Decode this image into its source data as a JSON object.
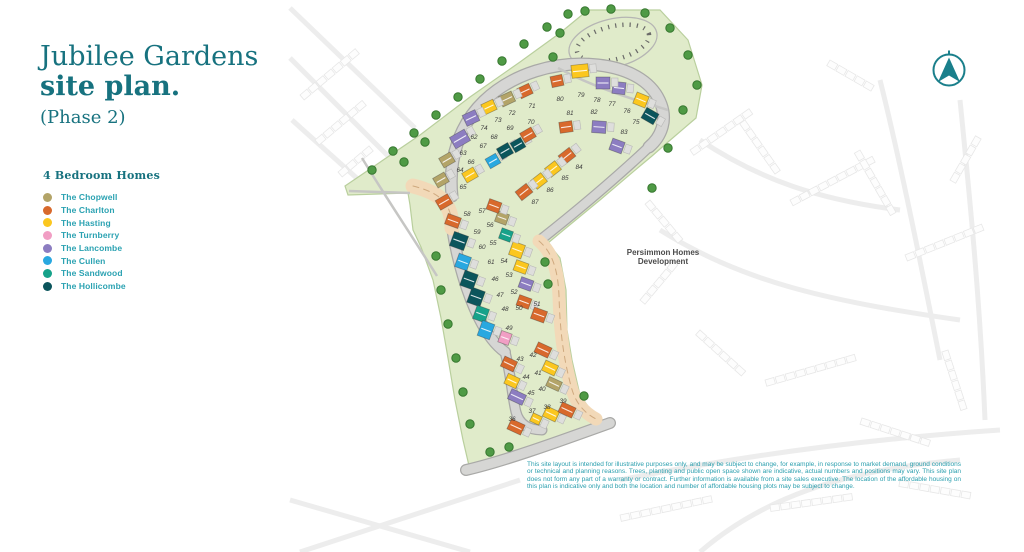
{
  "title": {
    "line1": "Jubilee Gardens",
    "line2": "site plan.",
    "phase": "(Phase 2)"
  },
  "legend": {
    "heading": "4 Bedroom Homes",
    "items": [
      {
        "key": "chopwell",
        "label": "The Chopwell",
        "color": "#b3a468"
      },
      {
        "key": "charlton",
        "label": "The Charlton",
        "color": "#d8692c"
      },
      {
        "key": "hasting",
        "label": "The Hasting",
        "color": "#fbc71f"
      },
      {
        "key": "turnberry",
        "label": "The Turnberry",
        "color": "#f19ec4"
      },
      {
        "key": "lancombe",
        "label": "The Lancombe",
        "color": "#8c7dc1"
      },
      {
        "key": "cullen",
        "label": "The Cullen",
        "color": "#29a8e0"
      },
      {
        "key": "sandwood",
        "label": "The Sandwood",
        "color": "#16a28a"
      },
      {
        "key": "hollicombe",
        "label": "The Hollicombe",
        "color": "#0b555c"
      }
    ]
  },
  "map": {
    "development_label_lines": [
      "Persimmon Homes",
      "Development"
    ],
    "site_colors": {
      "green": "#e0ebca",
      "green_edge": "#b9cf9d",
      "road": "#d6d6d4",
      "road_edge": "#a9a9a7",
      "tan_road": "#f2d9b8",
      "tan_dash": "#cfa97f",
      "tree": "#4f9a45",
      "tree_edge": "#36772f",
      "path": "#c6c6c4",
      "faint": "#e7e7e7"
    },
    "plots_columns": [
      "number",
      "type",
      "label_x",
      "label_y",
      "house_x",
      "house_y",
      "rotation",
      "width",
      "height"
    ],
    "plots": [
      [
        36,
        "charlton",
        512,
        419,
        516,
        427,
        25,
        15,
        11
      ],
      [
        37,
        "hasting",
        532,
        411,
        536,
        419,
        25,
        10,
        9
      ],
      [
        38,
        "hasting",
        547,
        407,
        551,
        414,
        25,
        14,
        11
      ],
      [
        39,
        "charlton",
        563,
        401,
        567,
        410,
        25,
        15,
        11
      ],
      [
        40,
        "chopwell",
        542,
        389,
        554,
        384,
        25,
        14,
        10
      ],
      [
        41,
        "hasting",
        538,
        373,
        550,
        368,
        25,
        14,
        11
      ],
      [
        42,
        "charlton",
        533,
        355,
        543,
        350,
        25,
        15,
        11
      ],
      [
        43,
        "charlton",
        520,
        359,
        509,
        364,
        25,
        14,
        11
      ],
      [
        44,
        "hasting",
        526,
        377,
        512,
        381,
        25,
        13,
        11
      ],
      [
        45,
        "lancombe",
        531,
        393,
        517,
        397,
        25,
        16,
        11
      ],
      [
        46,
        "hollicombe",
        495,
        279,
        476,
        297,
        20,
        14,
        16
      ],
      [
        47,
        "sandwood",
        500,
        295,
        481,
        314,
        20,
        13,
        14
      ],
      [
        48,
        "cullen",
        505,
        309,
        486,
        330,
        20,
        13,
        16
      ],
      [
        49,
        "turnberry",
        509,
        328,
        505,
        338,
        20,
        11,
        12
      ],
      [
        50,
        "charlton",
        519,
        308,
        524,
        302,
        20,
        13,
        11
      ],
      [
        51,
        "charlton",
        537,
        304,
        539,
        315,
        20,
        14,
        12
      ],
      [
        52,
        "lancombe",
        514,
        292,
        526,
        284,
        20,
        13,
        11
      ],
      [
        53,
        "hasting",
        509,
        275,
        521,
        267,
        20,
        13,
        11
      ],
      [
        54,
        "hasting",
        504,
        261,
        517,
        250,
        20,
        13,
        14
      ],
      [
        55,
        "sandwood",
        493,
        243,
        506,
        235,
        20,
        12,
        11
      ],
      [
        56,
        "chopwell",
        490,
        225,
        502,
        218,
        20,
        12,
        11
      ],
      [
        57,
        "charlton",
        482,
        211,
        494,
        206,
        20,
        13,
        11
      ],
      [
        58,
        "charlton",
        467,
        214,
        453,
        221,
        20,
        14,
        11
      ],
      [
        59,
        "hollicombe",
        477,
        232,
        459,
        241,
        20,
        15,
        15
      ],
      [
        60,
        "cullen",
        482,
        247,
        463,
        262,
        20,
        13,
        14
      ],
      [
        61,
        "hollicombe",
        491,
        262,
        469,
        280,
        20,
        14,
        16
      ],
      [
        62,
        "lancombe",
        474,
        137,
        460,
        139,
        -30,
        17,
        13
      ],
      [
        63,
        "chopwell",
        463,
        153,
        447,
        160,
        -30,
        13,
        11
      ],
      [
        64,
        "chopwell",
        460,
        170,
        441,
        180,
        -30,
        13,
        11
      ],
      [
        65,
        "charlton",
        463,
        187,
        444,
        202,
        -30,
        14,
        11
      ],
      [
        66,
        "hasting",
        471,
        162,
        470,
        175,
        -30,
        13,
        11
      ],
      [
        67,
        "cullen",
        483,
        146,
        493,
        161,
        -30,
        12,
        11
      ],
      [
        68,
        "hollicombe",
        494,
        137,
        505,
        151,
        -30,
        13,
        12
      ],
      [
        69,
        "hollicombe",
        510,
        128,
        518,
        145,
        -30,
        12,
        11
      ],
      [
        70,
        "charlton",
        531,
        122,
        528,
        135,
        -30,
        13,
        11
      ],
      [
        71,
        "charlton",
        532,
        106,
        525,
        91,
        -25,
        13,
        11
      ],
      [
        72,
        "chopwell",
        512,
        113,
        507,
        99,
        -25,
        14,
        11
      ],
      [
        73,
        "hasting",
        498,
        120,
        489,
        107,
        -25,
        13,
        11
      ],
      [
        74,
        "lancombe",
        484,
        128,
        471,
        118,
        -25,
        14,
        12
      ],
      [
        75,
        "hollicombe",
        636,
        122,
        650,
        116,
        30,
        14,
        12
      ],
      [
        76,
        "hasting",
        627,
        111,
        641,
        100,
        22,
        13,
        12
      ],
      [
        77,
        "lancombe",
        612,
        104,
        619,
        88,
        6,
        13,
        12
      ],
      [
        78,
        "lancombe",
        597,
        100,
        603,
        83,
        0,
        14,
        12
      ],
      [
        79,
        "hasting",
        581,
        95,
        580,
        71,
        -6,
        17,
        13
      ],
      [
        80,
        "charlton",
        560,
        99,
        557,
        81,
        -12,
        12,
        11
      ],
      [
        81,
        "charlton",
        570,
        113,
        566,
        127,
        -8,
        13,
        11
      ],
      [
        82,
        "lancombe",
        594,
        112,
        599,
        127,
        4,
        14,
        12
      ],
      [
        83,
        "lancombe",
        624,
        132,
        617,
        146,
        20,
        13,
        12
      ],
      [
        84,
        "charlton",
        579,
        167,
        567,
        156,
        -38,
        14,
        11
      ],
      [
        85,
        "hasting",
        565,
        178,
        553,
        169,
        -38,
        13,
        11
      ],
      [
        86,
        "hasting",
        550,
        190,
        539,
        181,
        -38,
        13,
        11
      ],
      [
        87,
        "charlton",
        535,
        202,
        524,
        192,
        -38,
        14,
        11
      ]
    ],
    "trees": [
      [
        372,
        170
      ],
      [
        393,
        151
      ],
      [
        414,
        133
      ],
      [
        436,
        115
      ],
      [
        458,
        97
      ],
      [
        480,
        79
      ],
      [
        502,
        61
      ],
      [
        524,
        44
      ],
      [
        547,
        27
      ],
      [
        568,
        14
      ],
      [
        404,
        162
      ],
      [
        425,
        142
      ],
      [
        585,
        11
      ],
      [
        611,
        9
      ],
      [
        645,
        13
      ],
      [
        670,
        28
      ],
      [
        688,
        55
      ],
      [
        697,
        85
      ],
      [
        683,
        110
      ],
      [
        560,
        33
      ],
      [
        553,
        57
      ],
      [
        652,
        188
      ],
      [
        668,
        148
      ],
      [
        436,
        256
      ],
      [
        441,
        290
      ],
      [
        448,
        324
      ],
      [
        456,
        358
      ],
      [
        463,
        392
      ],
      [
        470,
        424
      ],
      [
        490,
        452
      ],
      [
        509,
        447
      ],
      [
        545,
        262
      ],
      [
        548,
        284
      ],
      [
        584,
        396
      ]
    ]
  },
  "disclaimer": {
    "text": "This site layout is intended for illustrative purposes only, and may be subject to change, for example, in response to market demand, ground conditions or technical and planning reasons. Trees, planting and public open space shown are indicative, actual numbers and positions may vary. This site plan does not form any part of a warranty or contract. Further information is available from a site sales executive. The location of the affordable housing on this plan is indicative only and both the location and number of affordable housing plots may be subject to change."
  }
}
